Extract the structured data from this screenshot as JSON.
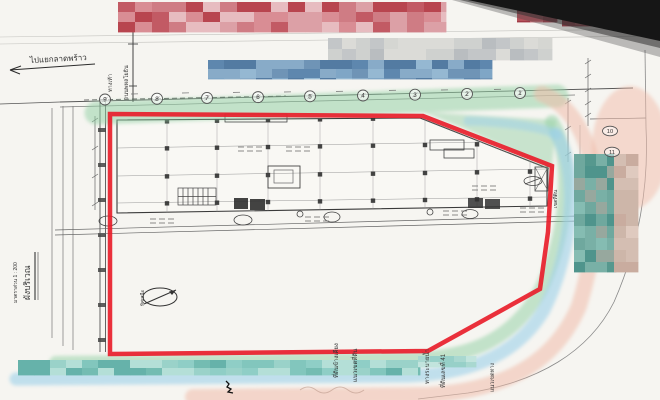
{
  "document": {
    "type": "scanned architectural site plan",
    "sheet_title": "ผังบริเวณ",
    "sheet_scale": "มาตราส่วน 1 : 200"
  },
  "labels": {
    "to_latphrao": "ไปแยกลาดพร้าว",
    "sidewalk": "ทางเท้า",
    "road": "ถนนพหลโยธิน",
    "north": "ทิศเหนือ",
    "adjacent_parcel": "ที่ดินข้างเคียง",
    "boundary": "แนวเขตที่ดิน",
    "drainage": "ทางระบายน้ำ",
    "parcel_no": "ที่ดินเลขที่ 41",
    "row_edge": "แนวเขตทาง",
    "parcel_edge": "เขตที่ดิน"
  },
  "grid": {
    "top_bubbles": [
      "9",
      "8",
      "7",
      "6",
      "5",
      "4",
      "3",
      "2",
      "1"
    ],
    "side_bubbles": [
      "10",
      "11"
    ]
  },
  "colors": {
    "boundary_red": "#e81e2b",
    "highlight_green": "#90cfa2",
    "highlight_blue": "#9cd0ea",
    "highlight_pink": "#f1bba9",
    "paper": "#f6f5f1",
    "scan_black": "#161616",
    "plan_ink": "#3a3a3a"
  },
  "redactions": [
    {
      "x": 118,
      "y": 2,
      "w": 328,
      "h": 30,
      "cw": 17,
      "ch": 10,
      "seed": 7,
      "palette": [
        "#c25a64",
        "#cf7c84",
        "#dca0a6",
        "#e7bcc0",
        "#b8454f",
        "#d98d94"
      ]
    },
    {
      "x": 517,
      "y": 3,
      "w": 40,
      "h": 19,
      "cw": 13,
      "ch": 9,
      "seed": 3,
      "palette": [
        "#a03a46",
        "#b5525b",
        "#c76971"
      ]
    },
    {
      "x": 562,
      "y": 3,
      "w": 78,
      "h": 23,
      "cw": 13,
      "ch": 11,
      "seed": 5,
      "palette": [
        "#9e3340",
        "#b24a52",
        "#c4666e",
        "#8f2d3a"
      ]
    },
    {
      "x": 328,
      "y": 38,
      "w": 224,
      "h": 22,
      "cw": 14,
      "ch": 11,
      "seed": 11,
      "palette": [
        "#c3c6c8",
        "#cfd1cf",
        "#dbdbd7",
        "#b9bdc0",
        "#d5d6d2"
      ]
    },
    {
      "x": 208,
      "y": 60,
      "w": 284,
      "h": 19,
      "cw": 16,
      "ch": 9,
      "seed": 13,
      "palette": [
        "#5e87ae",
        "#7fa6c6",
        "#95b8d2",
        "#6f94b6",
        "#537ba2",
        "#88abc8"
      ]
    },
    {
      "x": 574,
      "y": 154,
      "w": 42,
      "h": 118,
      "cw": 11,
      "ch": 12,
      "seed": 17,
      "palette": [
        "#6fa89e",
        "#56988e",
        "#85bcb2",
        "#97a89e",
        "#4f948c",
        "#79b0a6"
      ]
    },
    {
      "x": 614,
      "y": 154,
      "w": 24,
      "h": 118,
      "cw": 12,
      "ch": 12,
      "seed": 19,
      "palette": [
        "#d4beb2",
        "#c9ac9f",
        "#dfcabf",
        "#cdb6a9"
      ]
    },
    {
      "x": 18,
      "y": 360,
      "w": 402,
      "h": 15,
      "cw": 16,
      "ch": 8,
      "seed": 23,
      "palette": [
        "#66b2aa",
        "#82c6bd",
        "#9ad2c9",
        "#b4dfd7",
        "#8fcec6",
        "#74bcb2"
      ]
    },
    {
      "x": 418,
      "y": 356,
      "w": 58,
      "h": 11,
      "cw": 12,
      "ch": 6,
      "seed": 29,
      "palette": [
        "#a9d8d0",
        "#c2e4dd",
        "#97d0c8"
      ]
    }
  ]
}
